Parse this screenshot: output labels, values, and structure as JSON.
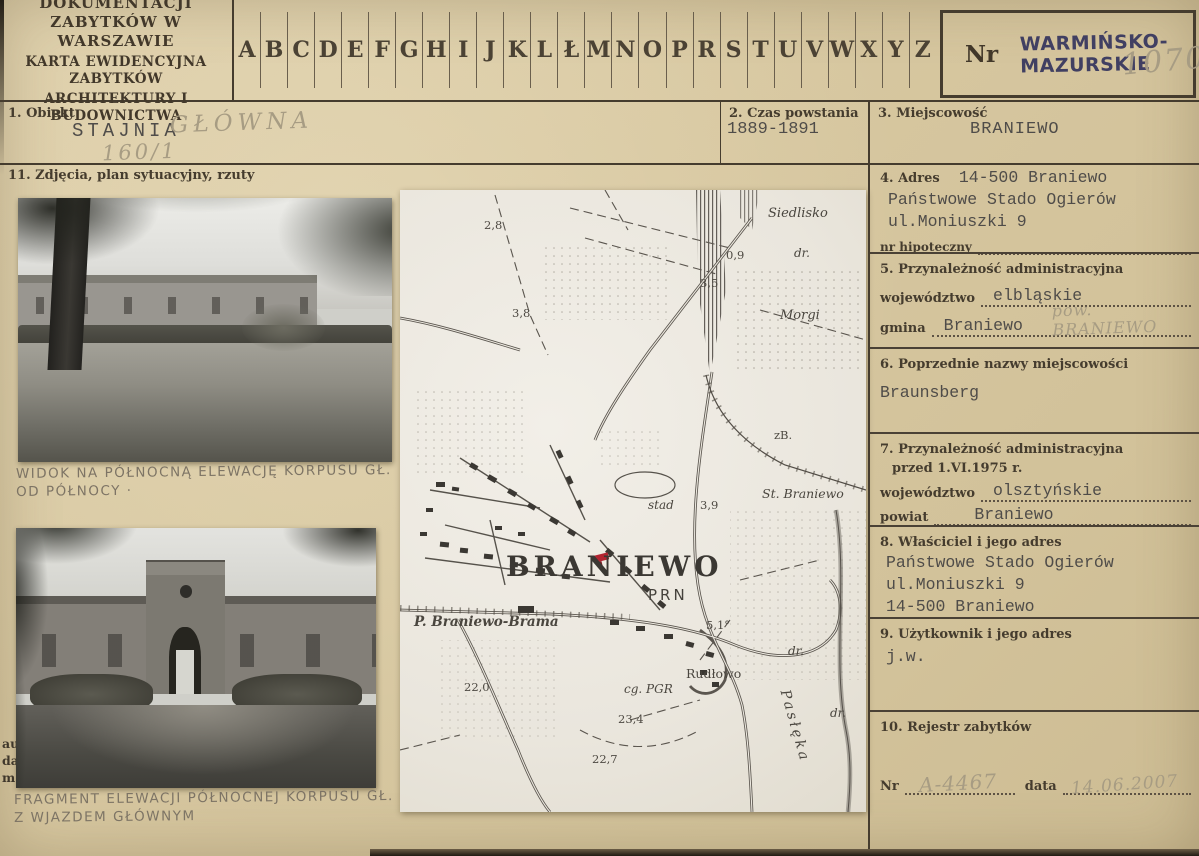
{
  "header": {
    "institution_line1": "OŚRODEK DOKUMENTACJI",
    "institution_line2": "ZABYTKÓW W WARSZAWIE",
    "card_type_line1": "KARTA EWIDENCYJNA ZABYTKÓW",
    "card_type_line2": "ARCHITEKTURY I BUDOWNICTWA",
    "index_letters": [
      "A",
      "B",
      "C",
      "D",
      "E",
      "F",
      "G",
      "H",
      "I",
      "J",
      "K",
      "L",
      "Ł",
      "M",
      "N",
      "O",
      "P",
      "R",
      "S",
      "T",
      "U",
      "V",
      "W",
      "X",
      "Y",
      "Z"
    ],
    "nr_label": "Nr",
    "voivodeship_stamp_line1": "WARMIŃSKO-",
    "voivodeship_stamp_line2": "MAZURSKIE",
    "nr_handwritten": "1070"
  },
  "fields": {
    "f1": {
      "label": "1. Obiekt",
      "typed": "STAJNIA",
      "handwritten_name": "GŁÓWNA",
      "handwritten_number": "160/1"
    },
    "f2": {
      "label": "2. Czas powstania",
      "value": "1889-1891"
    },
    "f3": {
      "label": "3. Miejscowość",
      "value": "BRANIEWO"
    },
    "f4": {
      "label": "4. Adres",
      "value_line1": "14-500 Braniewo",
      "value_line2": "Państwowe Stado Ogierów",
      "value_line3": "ul.Moniuszki 9",
      "sub_label": "nr hipoteczny"
    },
    "f5": {
      "label": "5. Przynależność administracyjna",
      "wojewodztwo_label": "województwo",
      "wojewodztwo_value": "elbląskie",
      "gmina_label": "gmina",
      "gmina_value": "Braniewo",
      "gmina_handwritten": "pow. BRANIEWO"
    },
    "f6": {
      "label": "6. Poprzednie nazwy miejscowości",
      "value": "Braunsberg"
    },
    "f7": {
      "label_line1": "7. Przynależność administracyjna",
      "label_line2": "przed 1.VI.1975 r.",
      "wojewodztwo_label": "województwo",
      "wojewodztwo_value": "olsztyńskie",
      "powiat_label": "powiat",
      "powiat_value": "Braniewo"
    },
    "f8": {
      "label": "8. Właściciel i jego adres",
      "value_line1": "Państwowe Stado Ogierów",
      "value_line2": "ul.Moniuszki 9",
      "value_line3": "14-500 Braniewo"
    },
    "f9": {
      "label": "9. Użytkownik i jego adres",
      "value": "j.w."
    },
    "f10": {
      "label": "10. Rejestr zabytków",
      "nr_label": "Nr",
      "nr_value": "A-4467",
      "data_label": "data",
      "data_value": "14.06.2007"
    },
    "f11": {
      "label": "11. Zdjęcia, plan sytuacyjny, rzuty"
    }
  },
  "photos": {
    "caption1_line1": "WIDOK NA PÓŁNOCNĄ ELEWACJĘ KORPUSU GŁ.",
    "caption1_line2": "OD PÓŁNOCY ·",
    "caption2_line1": "FRAGMENT ELEWACJI PÓŁNOCNEJ KORPUSU GŁ.",
    "caption2_line2": "Z WJAZDEM GŁÓWNYM",
    "margin_lines": [
      "au",
      "da",
      "m"
    ]
  },
  "map": {
    "labels": {
      "siedlisko": "Siedlisko",
      "dr_top": "dr.",
      "morgi": "Morgi",
      "zb": "zB.",
      "st_braniewo": "St. Braniewo",
      "stad": "stad",
      "braniewo": "BRANIEWO",
      "prn": "PRN",
      "brama": "P. Braniewo-Brama",
      "rudlowo": "Rudłowo",
      "cg_pgr": "cg. PGR",
      "pasleka": "Pasłęka",
      "dr_right": "dr.",
      "dr_low": "dr."
    },
    "elevations": {
      "n28": "2,8",
      "n09": "0,9",
      "n35": "3,5",
      "n38": "3,8",
      "n39": "3,9",
      "n51": "5,1°",
      "n220": "22,0",
      "n234": "23,4",
      "n227": "22,7"
    }
  },
  "colors": {
    "card_background": "#d7c7a0",
    "rule_ink": "#453c2e",
    "typewriter_ink": "#4f4c49",
    "pencil": "#a79c83",
    "stamp_ink": "#403f62",
    "map_paper": "#eae6dd",
    "map_ink": "#56524b",
    "red_marker": "#b22531"
  }
}
